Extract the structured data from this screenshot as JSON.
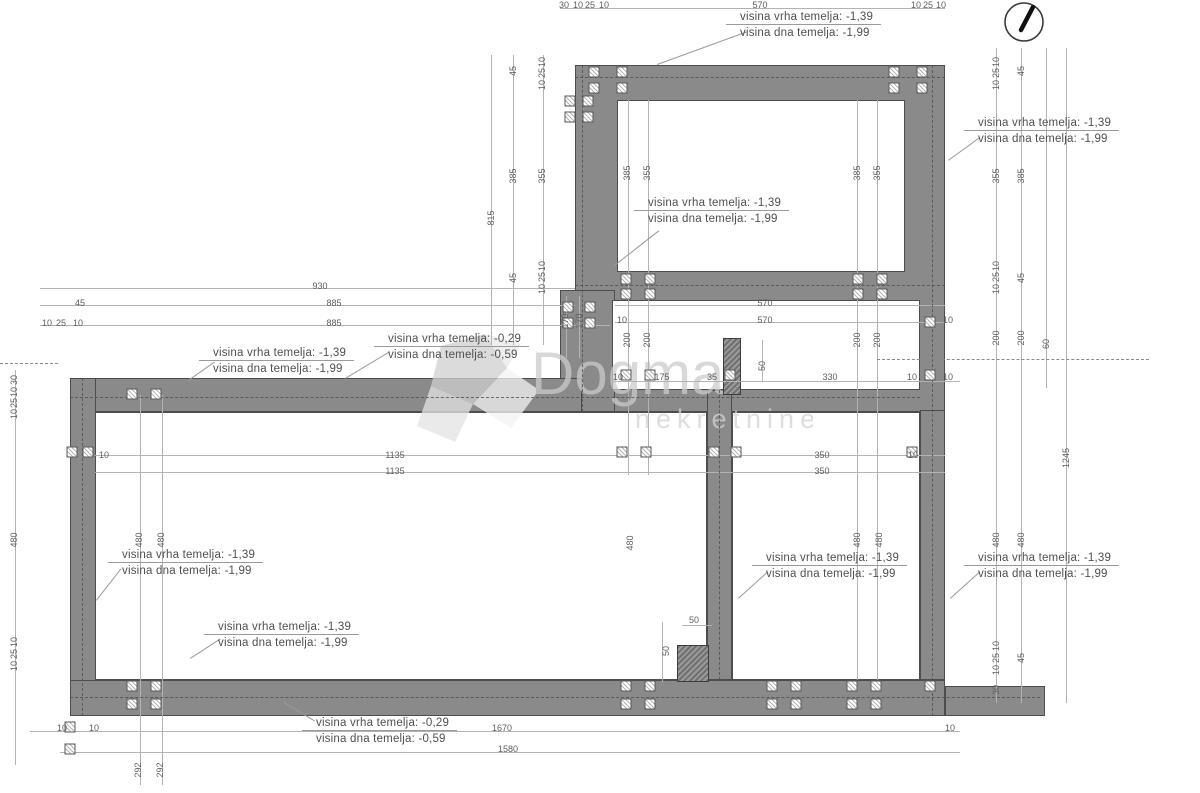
{
  "watermark": {
    "title": "Dogma",
    "subtitle": "nekretnine"
  },
  "annotations": [
    {
      "line1": "visina vrha temelja: -1,39",
      "line2": "visina dna temelja: -1,99",
      "x": 740,
      "y": 10,
      "diag": [
        657,
        64,
        95,
        -20
      ]
    },
    {
      "line1": "visina vrha temelja: -1,39",
      "line2": "visina dna temelja: -1,99",
      "x": 978,
      "y": 116,
      "diag": [
        948,
        160,
        38,
        -36
      ]
    },
    {
      "line1": "visina vrha temelja: -1,39",
      "line2": "visina dna temelja: -1,99",
      "x": 648,
      "y": 196,
      "diag": [
        613,
        266,
        58,
        -38
      ]
    },
    {
      "line1": "visina vrha temelja: -1,39",
      "line2": "visina dna temelja: -1,99",
      "x": 213,
      "y": 346,
      "diag": [
        188,
        380,
        32,
        -35
      ]
    },
    {
      "line1": "visina vrha temelja: -0,29",
      "line2": "visina dna temelja: -0,59",
      "x": 388,
      "y": 332,
      "diag": [
        345,
        378,
        52,
        -31
      ]
    },
    {
      "line1": "visina vrha temelja: -1,39",
      "line2": "visina dna temelja: -1,99",
      "x": 122,
      "y": 548,
      "diag": [
        96,
        600,
        40,
        -52
      ]
    },
    {
      "line1": "visina vrha temelja: -1,39",
      "line2": "visina dna temelja: -1,99",
      "x": 218,
      "y": 620,
      "diag": [
        190,
        658,
        36,
        -33
      ]
    },
    {
      "line1": "visina vrha temelja: -1,39",
      "line2": "visina dna temelja: -1,99",
      "x": 766,
      "y": 551,
      "diag": [
        738,
        598,
        40,
        -42
      ]
    },
    {
      "line1": "visina vrha temelja: -1,39",
      "line2": "visina dna temelja: -1,99",
      "x": 978,
      "y": 551,
      "diag": [
        950,
        598,
        40,
        -42
      ]
    },
    {
      "line1": "visina vrha temelja: -0,29",
      "line2": "visina dna temelja: -0,59",
      "x": 316,
      "y": 716,
      "diag": [
        284,
        702,
        36,
        31
      ]
    }
  ],
  "drawing": {
    "walls": [
      [
        575,
        65,
        370,
        347
      ],
      [
        560,
        290,
        55,
        122
      ],
      [
        70,
        378,
        512,
        34
      ],
      [
        70,
        378,
        26,
        338
      ],
      [
        70,
        680,
        875,
        36
      ],
      [
        945,
        686,
        100,
        30
      ],
      [
        707,
        390,
        25,
        290
      ],
      [
        920,
        410,
        25,
        270
      ]
    ],
    "overwalls": [
      [
        723,
        338,
        18,
        57
      ],
      [
        677,
        645,
        32,
        37
      ]
    ],
    "rooms": [
      [
        617,
        100,
        288,
        172
      ],
      [
        612,
        300,
        308,
        90
      ],
      [
        95,
        412,
        612,
        268
      ],
      [
        732,
        412,
        188,
        268
      ]
    ],
    "hlines": [
      [
        560,
        8,
        385
      ],
      [
        40,
        288,
        535
      ],
      [
        40,
        305,
        535
      ],
      [
        40,
        325,
        570
      ],
      [
        615,
        305,
        330
      ],
      [
        615,
        322,
        330
      ],
      [
        612,
        381,
        348
      ],
      [
        95,
        455,
        850
      ],
      [
        95,
        472,
        850
      ],
      [
        682,
        625,
        30
      ],
      [
        30,
        731,
        930
      ],
      [
        60,
        752,
        900
      ]
    ],
    "vlines": [
      [
        15,
        370,
        395
      ],
      [
        140,
        395,
        390
      ],
      [
        162,
        395,
        390
      ],
      [
        491,
        55,
        290
      ],
      [
        513,
        55,
        290
      ],
      [
        543,
        55,
        290
      ],
      [
        566,
        296,
        62
      ],
      [
        579,
        296,
        62
      ],
      [
        628,
        100,
        375
      ],
      [
        648,
        100,
        375
      ],
      [
        857,
        100,
        580
      ],
      [
        877,
        100,
        580
      ],
      [
        996,
        48,
        655
      ],
      [
        1021,
        48,
        655
      ],
      [
        1046,
        48,
        340
      ],
      [
        1066,
        48,
        655
      ],
      [
        762,
        340,
        42
      ],
      [
        662,
        622,
        60
      ]
    ],
    "hdash": [
      [
        70,
        397,
        850
      ],
      [
        70,
        697,
        970
      ],
      [
        575,
        77,
        370
      ],
      [
        575,
        285,
        370
      ]
    ],
    "xdash": [
      [
        0,
        363,
        58
      ],
      [
        877,
        359,
        272
      ]
    ],
    "vdash": [
      [
        582,
        65,
        347
      ],
      [
        932,
        65,
        651
      ],
      [
        82,
        378,
        338
      ],
      [
        719,
        390,
        290
      ]
    ],
    "markers": [
      [
        594,
        72
      ],
      [
        622,
        72
      ],
      [
        894,
        72
      ],
      [
        922,
        72
      ],
      [
        594,
        88
      ],
      [
        622,
        88
      ],
      [
        894,
        88
      ],
      [
        922,
        88
      ],
      [
        570,
        101
      ],
      [
        588,
        101
      ],
      [
        570,
        117
      ],
      [
        588,
        117
      ],
      [
        626,
        279
      ],
      [
        650,
        279
      ],
      [
        858,
        279
      ],
      [
        882,
        279
      ],
      [
        626,
        294
      ],
      [
        650,
        294
      ],
      [
        858,
        294
      ],
      [
        882,
        294
      ],
      [
        568,
        307
      ],
      [
        590,
        307
      ],
      [
        568,
        323
      ],
      [
        590,
        323
      ],
      [
        626,
        375
      ],
      [
        650,
        375
      ],
      [
        730,
        375
      ],
      [
        930,
        322
      ],
      [
        930,
        375
      ],
      [
        132,
        394
      ],
      [
        156,
        394
      ],
      [
        72,
        452
      ],
      [
        88,
        452
      ],
      [
        622,
        452
      ],
      [
        646,
        452
      ],
      [
        714,
        452
      ],
      [
        736,
        452
      ],
      [
        912,
        452
      ],
      [
        132,
        686
      ],
      [
        156,
        686
      ],
      [
        626,
        686
      ],
      [
        650,
        686
      ],
      [
        772,
        686
      ],
      [
        796,
        686
      ],
      [
        852,
        686
      ],
      [
        876,
        686
      ],
      [
        132,
        704
      ],
      [
        156,
        704
      ],
      [
        626,
        704
      ],
      [
        650,
        704
      ],
      [
        772,
        704
      ],
      [
        796,
        704
      ],
      [
        852,
        704
      ],
      [
        876,
        704
      ],
      [
        70,
        727
      ],
      [
        70,
        749
      ],
      [
        930,
        686
      ]
    ],
    "labels": [
      [
        "30",
        564,
        5,
        0
      ],
      [
        "10",
        578,
        5,
        0
      ],
      [
        "25",
        590,
        5,
        0
      ],
      [
        "10",
        604,
        5,
        0
      ],
      [
        "570",
        760,
        5,
        0
      ],
      [
        "10",
        916,
        5,
        0
      ],
      [
        "25",
        928,
        5,
        0
      ],
      [
        "10",
        941,
        5,
        0
      ],
      [
        "45",
        513,
        71,
        1
      ],
      [
        "10",
        542,
        62,
        1
      ],
      [
        "25",
        542,
        73,
        1
      ],
      [
        "10",
        542,
        85,
        1
      ],
      [
        "815",
        491,
        218,
        1
      ],
      [
        "385",
        513,
        176,
        1
      ],
      [
        "355",
        542,
        176,
        1
      ],
      [
        "45",
        513,
        278,
        1
      ],
      [
        "10",
        542,
        266,
        1
      ],
      [
        "25",
        542,
        277,
        1
      ],
      [
        "10",
        542,
        289,
        1
      ],
      [
        "170",
        565,
        321,
        1
      ],
      [
        "170",
        579,
        321,
        1
      ],
      [
        "385",
        627,
        173,
        1
      ],
      [
        "355",
        647,
        173,
        1
      ],
      [
        "385",
        857,
        173,
        1
      ],
      [
        "355",
        877,
        173,
        1
      ],
      [
        "10",
        996,
        62,
        1
      ],
      [
        "25",
        996,
        73,
        1
      ],
      [
        "10",
        996,
        85,
        1
      ],
      [
        "45",
        1021,
        71,
        1
      ],
      [
        "355",
        996,
        176,
        1
      ],
      [
        "385",
        1021,
        176,
        1
      ],
      [
        "10",
        996,
        266,
        1
      ],
      [
        "25",
        996,
        277,
        1
      ],
      [
        "10",
        996,
        289,
        1
      ],
      [
        "45",
        1021,
        278,
        1
      ],
      [
        "200",
        996,
        338,
        1
      ],
      [
        "200",
        1021,
        338,
        1
      ],
      [
        "60",
        1046,
        344,
        1
      ],
      [
        "1245",
        1066,
        458,
        1
      ],
      [
        "480",
        996,
        540,
        1
      ],
      [
        "480",
        1021,
        540,
        1
      ],
      [
        "10",
        996,
        646,
        1
      ],
      [
        "25",
        996,
        658,
        1
      ],
      [
        "10",
        996,
        670,
        1
      ],
      [
        "30",
        996,
        690,
        1
      ],
      [
        "45",
        1021,
        658,
        1
      ],
      [
        "930",
        320,
        286,
        0
      ],
      [
        "45",
        80,
        303,
        0
      ],
      [
        "885",
        334,
        303,
        0
      ],
      [
        "10",
        47,
        323,
        0
      ],
      [
        "25",
        61,
        323,
        0
      ],
      [
        "10",
        78,
        323,
        0
      ],
      [
        "885",
        334,
        323,
        0
      ],
      [
        "570",
        765,
        303,
        0
      ],
      [
        "570",
        765,
        320,
        0
      ],
      [
        "10",
        622,
        320,
        0
      ],
      [
        "10",
        948,
        320,
        0
      ],
      [
        "200",
        627,
        340,
        1
      ],
      [
        "200",
        647,
        340,
        1
      ],
      [
        "200",
        857,
        340,
        1
      ],
      [
        "200",
        877,
        340,
        1
      ],
      [
        "10",
        618,
        377,
        0
      ],
      [
        "175",
        662,
        377,
        0
      ],
      [
        "35",
        712,
        377,
        0
      ],
      [
        "330",
        830,
        377,
        0
      ],
      [
        "10",
        912,
        377,
        0
      ],
      [
        "10",
        948,
        377,
        0
      ],
      [
        "50",
        762,
        366,
        1
      ],
      [
        "10",
        104,
        455,
        0
      ],
      [
        "1135",
        395,
        455,
        0
      ],
      [
        "1135",
        395,
        471,
        0
      ],
      [
        "350",
        822,
        455,
        0
      ],
      [
        "350",
        822,
        471,
        0
      ],
      [
        "10",
        913,
        455,
        0
      ],
      [
        "480",
        14,
        540,
        1
      ],
      [
        "30",
        14,
        380,
        1
      ],
      [
        "10",
        14,
        392,
        1
      ],
      [
        "25",
        14,
        403,
        1
      ],
      [
        "10",
        14,
        414,
        1
      ],
      [
        "10",
        14,
        642,
        1
      ],
      [
        "25",
        14,
        654,
        1
      ],
      [
        "10",
        14,
        666,
        1
      ],
      [
        "480",
        139,
        540,
        1
      ],
      [
        "480",
        161,
        540,
        1
      ],
      [
        "480",
        630,
        543,
        1
      ],
      [
        "480",
        857,
        540,
        1
      ],
      [
        "480",
        879,
        540,
        1
      ],
      [
        "50",
        694,
        620,
        0
      ],
      [
        "50",
        666,
        651,
        1
      ],
      [
        "1670",
        502,
        728,
        0
      ],
      [
        "10",
        950,
        728,
        0
      ],
      [
        "1580",
        508,
        749,
        0
      ],
      [
        "10",
        62,
        728,
        0
      ],
      [
        "10",
        94,
        728,
        0
      ],
      [
        "292",
        138,
        770,
        1
      ],
      [
        "292",
        160,
        770,
        1
      ]
    ]
  },
  "compass": {
    "label": "north-arrow"
  }
}
